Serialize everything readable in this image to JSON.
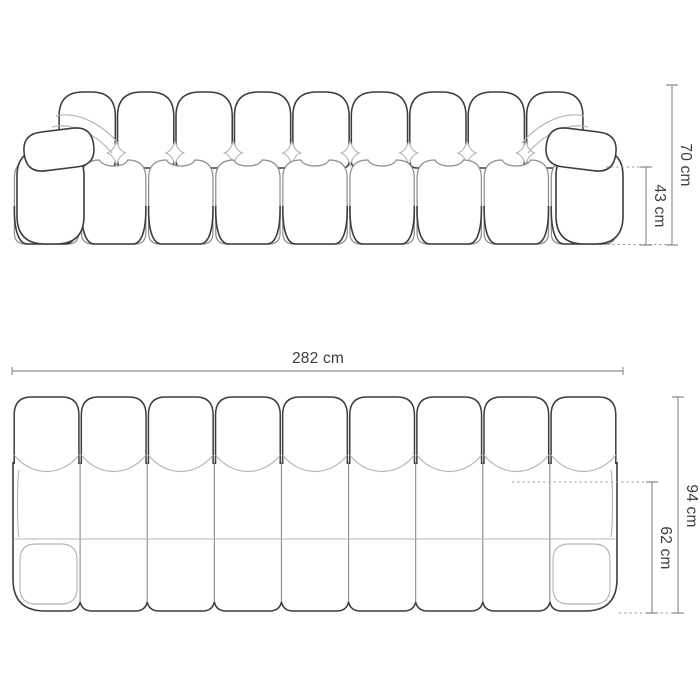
{
  "figure": {
    "subject": "modular-sofa-dimension-drawing",
    "views": {
      "front": {
        "label": "front elevation",
        "modules_back": 9,
        "modules_seat": 9,
        "armrests": 2
      },
      "top": {
        "label": "plan view",
        "grid_cols": 9,
        "grid_rows": 3
      }
    },
    "dimensions": {
      "overall_height": {
        "label": "70 cm",
        "value": 70,
        "unit": "cm"
      },
      "seat_height": {
        "label": "43 cm",
        "value": 43,
        "unit": "cm"
      },
      "overall_width": {
        "label": "282 cm",
        "value": 282,
        "unit": "cm"
      },
      "overall_depth": {
        "label": "94 cm",
        "value": 94,
        "unit": "cm"
      },
      "seat_depth": {
        "label": "62 cm",
        "value": 62,
        "unit": "cm"
      }
    },
    "colors": {
      "outline_dark": "#3d3d3d",
      "outline_mid": "#8f8f8f",
      "outline_light": "#b5b5b5",
      "dim_line": "#8c8c8c",
      "dim_dotted": "#9a9a9a",
      "text": "#3c3c3c",
      "background": "#ffffff"
    }
  }
}
